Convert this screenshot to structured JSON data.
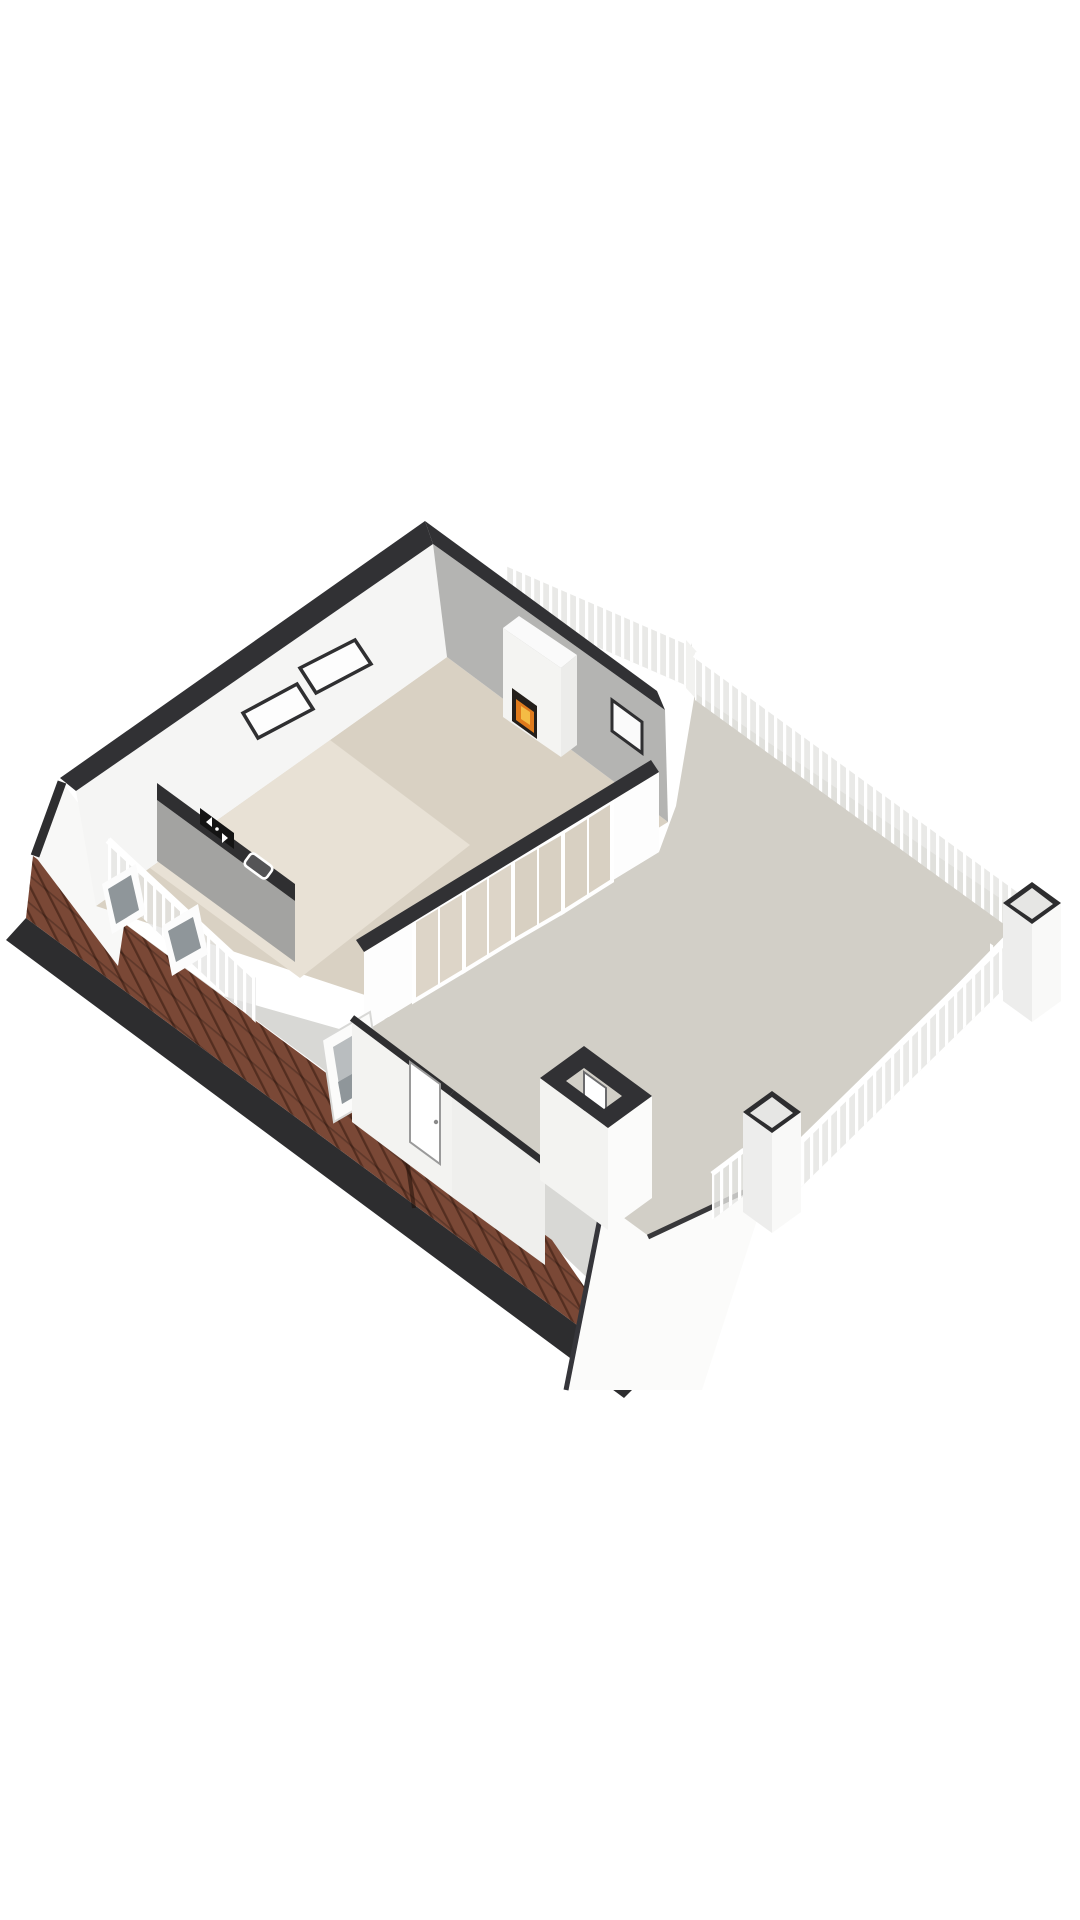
{
  "meta": {
    "type": "3d-floorplan-render",
    "view": "axonometric-birdseye",
    "floor": "attic-with-roof-terrace",
    "background": "#ffffff"
  },
  "colors": {
    "background": "#ffffff",
    "wall_cap": "#313134",
    "wall_white": "#f5f5f4",
    "wall_white_bright": "#fdfdfd",
    "wall_gray": "#b4b4b2",
    "gable_white": "#f8f8f7",
    "floor_room": "#d9d1c3",
    "floor_room_light": "#e8e1d5",
    "floor_terrace": "#d2cfc7",
    "walkway_gray": "#d8d8d5",
    "roof_brown": "#7a4836",
    "roof_tile_line": "#4e2718",
    "eave_black": "#2d2d2f",
    "railing_white": "#ffffff",
    "railing_shadow": "#e3e3e1",
    "door_glass": "#d8d0c2",
    "glass_dark": "#8f969a",
    "firebox_black": "#241f1b",
    "flame_orange": "#e07b1c",
    "flame_yellow": "#f4bc45",
    "counter_top": "#2f2f31",
    "counter_face": "#a3a3a1",
    "chimney_face": "#ededec",
    "chimney_face_bright": "#f9f9f8",
    "chimney_inner": "#e6e6e4",
    "bulkhead_face": "#f3f3f1",
    "white_roof_panel": "#fbfbfa"
  },
  "scene": {
    "elements": [
      {
        "name": "attic-living-room",
        "kind": "room"
      },
      {
        "name": "fireplace",
        "kind": "fixture"
      },
      {
        "name": "roof-window-left-wall-1",
        "kind": "window"
      },
      {
        "name": "roof-window-left-wall-2",
        "kind": "window"
      },
      {
        "name": "kitchen-counter",
        "kind": "fixture"
      },
      {
        "name": "cooktop",
        "kind": "appliance"
      },
      {
        "name": "sink",
        "kind": "appliance"
      },
      {
        "name": "stair-void-railing",
        "kind": "railing"
      },
      {
        "name": "roof-terrace",
        "kind": "terrace"
      },
      {
        "name": "terrace-railing-top",
        "kind": "railing"
      },
      {
        "name": "terrace-railing-side",
        "kind": "railing"
      },
      {
        "name": "chimney-right",
        "kind": "chimney"
      },
      {
        "name": "chimney-bottom",
        "kind": "chimney"
      },
      {
        "name": "glass-door-wall",
        "kind": "wall",
        "door_panels": 4
      },
      {
        "name": "stair-bulkhead-door",
        "kind": "door"
      },
      {
        "name": "exterior-door",
        "kind": "door"
      },
      {
        "name": "tiled-roof-slope",
        "kind": "roof"
      },
      {
        "name": "open-skylight",
        "kind": "window"
      },
      {
        "name": "roof-skylight-1",
        "kind": "window"
      },
      {
        "name": "roof-skylight-2",
        "kind": "window"
      },
      {
        "name": "left-gable-wall",
        "kind": "wall"
      },
      {
        "name": "bottom-gable-panel",
        "kind": "roof"
      }
    ]
  }
}
